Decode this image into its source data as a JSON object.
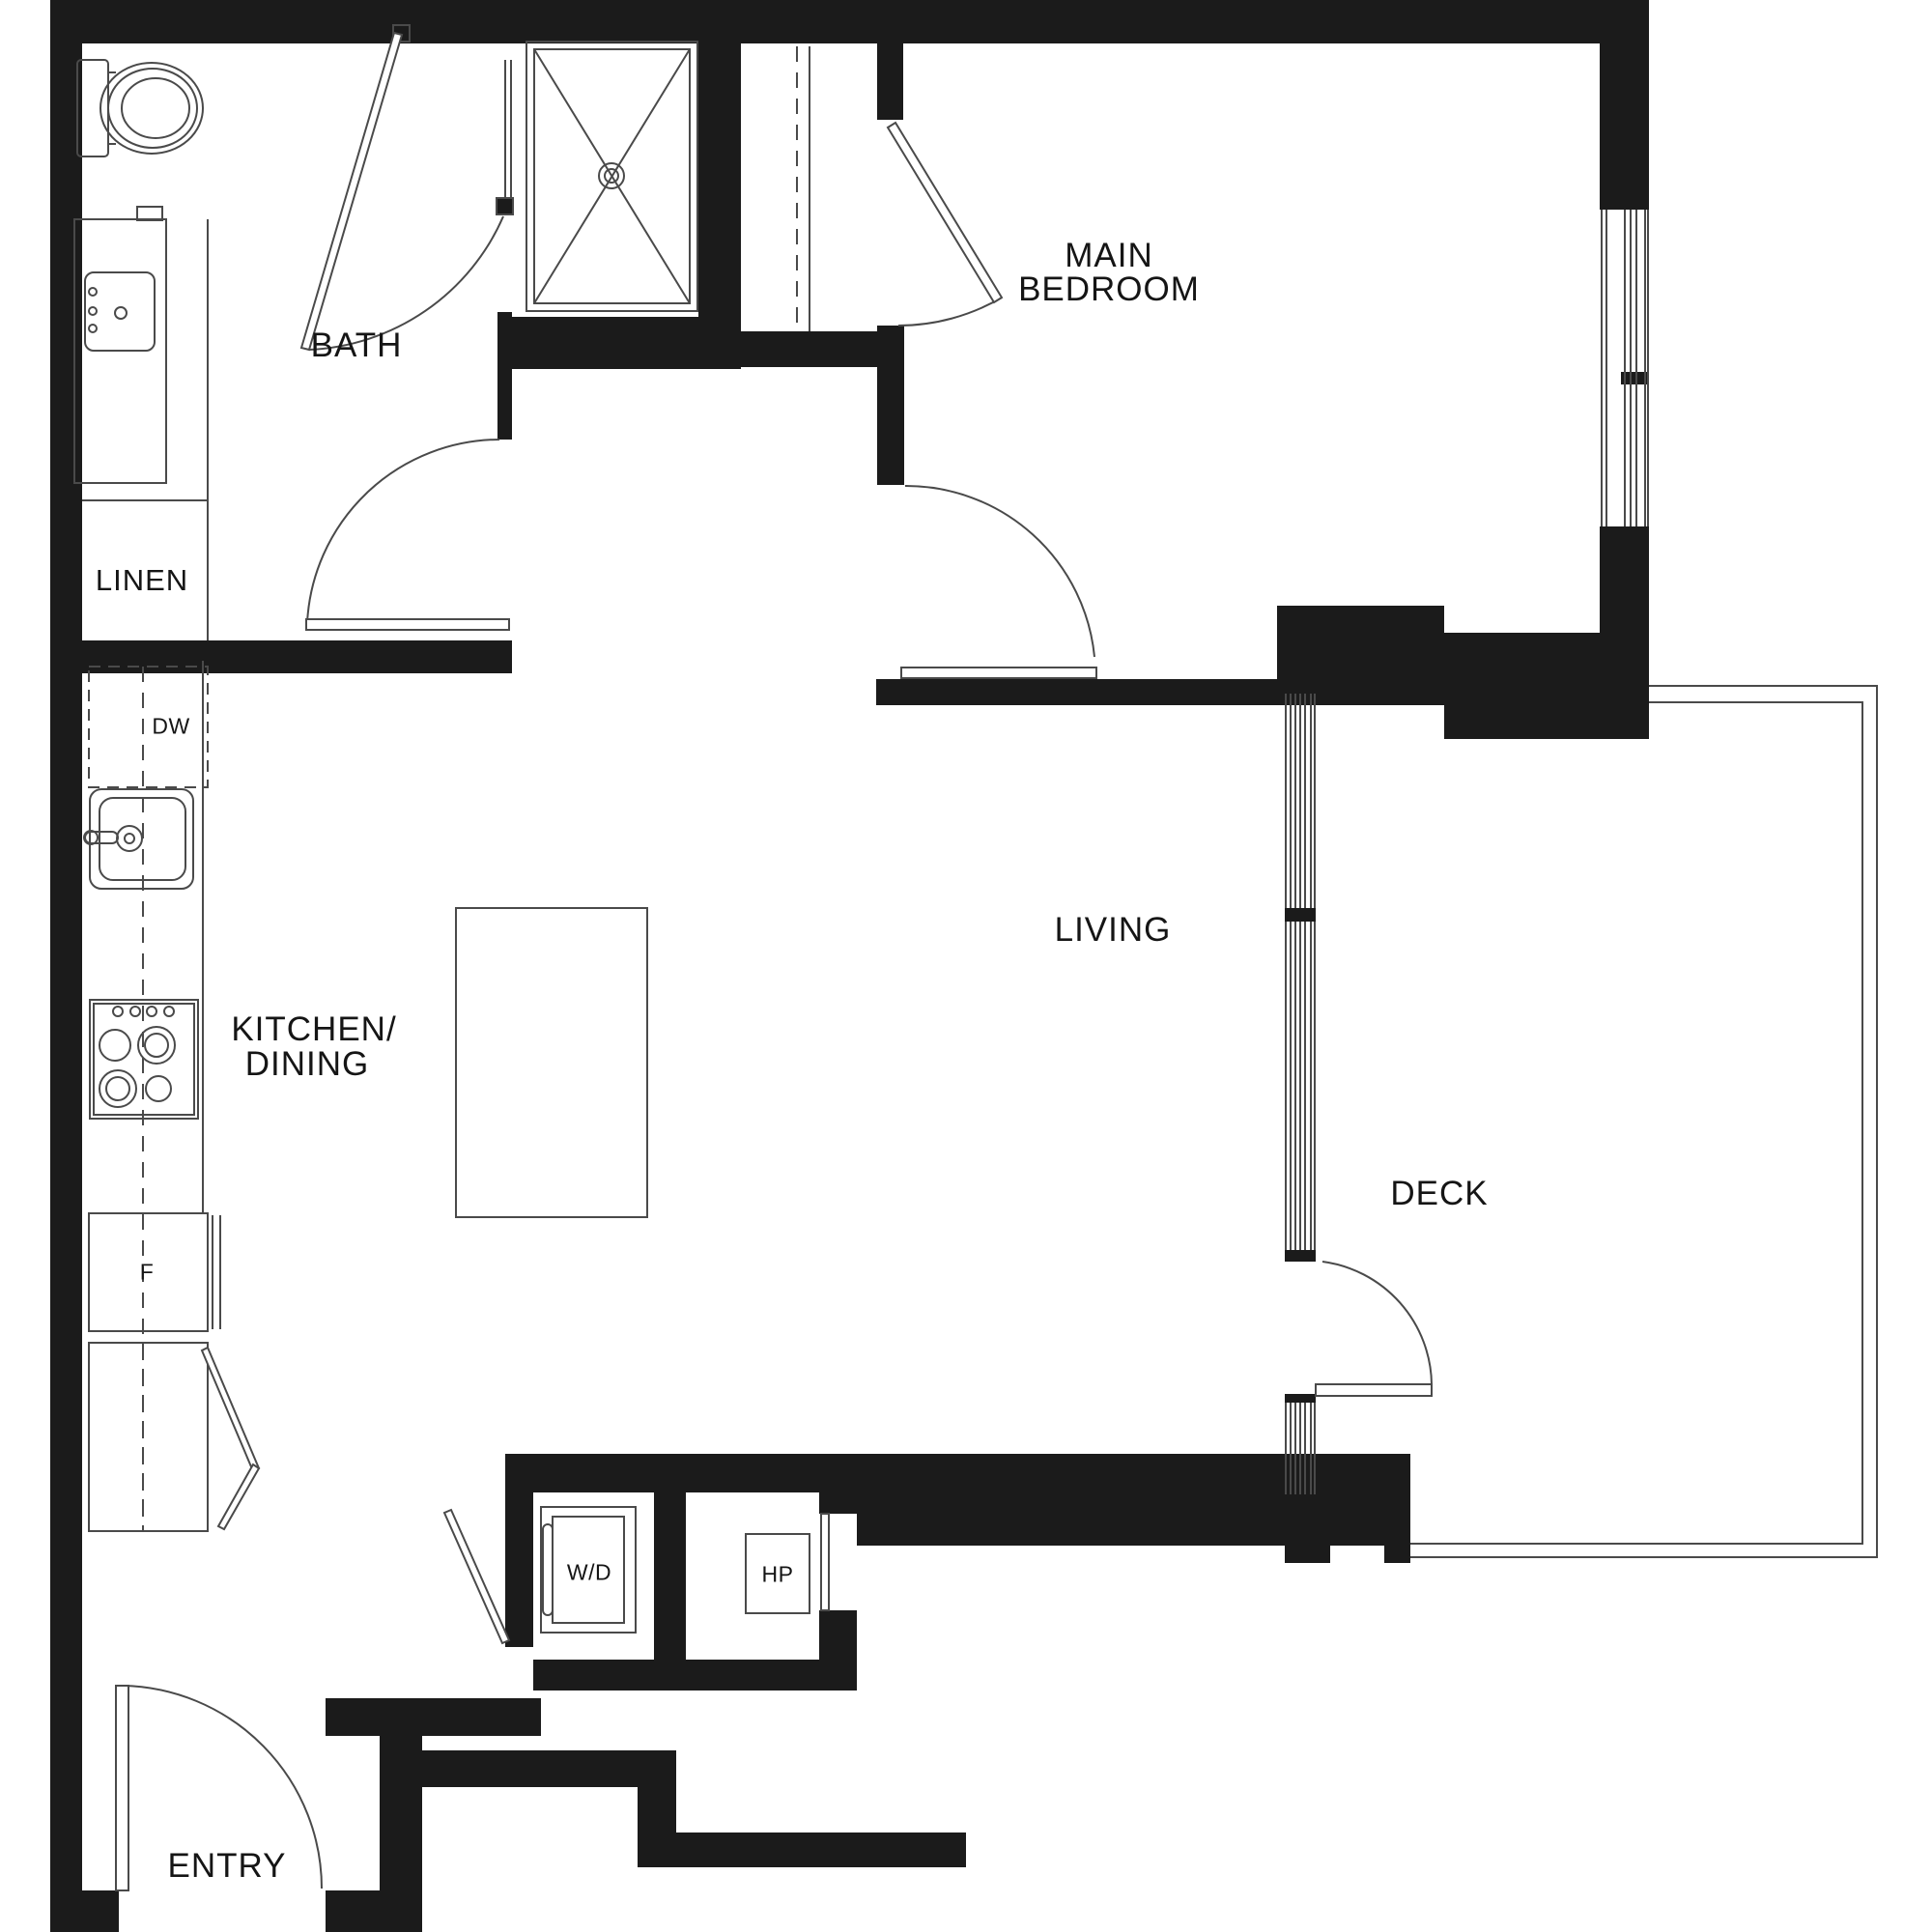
{
  "title": "One-bedroom apartment floor plan",
  "colors": {
    "wall": "#1b1b1b",
    "line": "#4a4a4a",
    "background": "#ffffff",
    "text": "#151515"
  },
  "rooms": {
    "bath": "BATH",
    "linen": "LINEN",
    "main_bedroom_line1": "MAIN",
    "main_bedroom_line2": "BEDROOM",
    "kitchen_line1": "KITCHEN/",
    "kitchen_line2": "DINING",
    "living": "LIVING",
    "deck": "DECK",
    "entry": "ENTRY"
  },
  "appliances": {
    "dishwasher": "DW",
    "fridge": "F",
    "washer_dryer": "W/D",
    "heat_pump": "HP"
  }
}
